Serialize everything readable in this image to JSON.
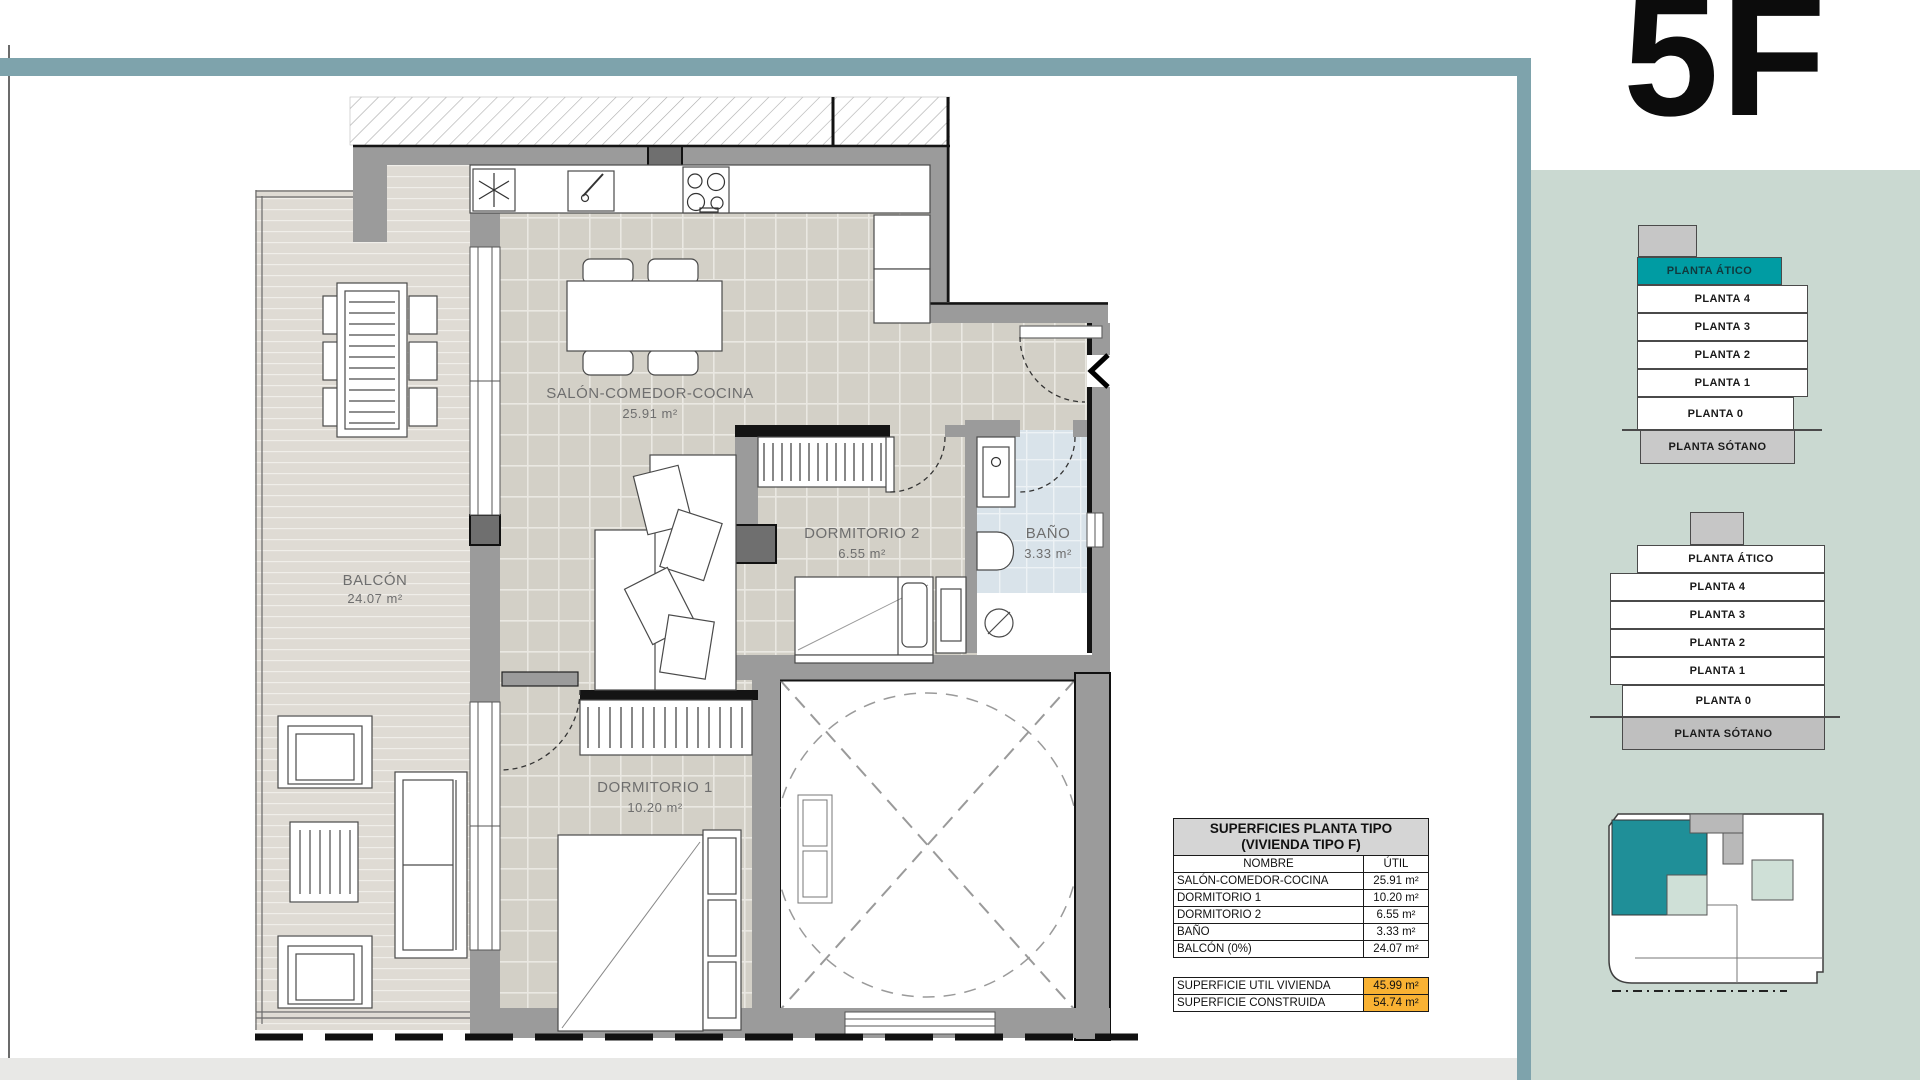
{
  "page": {
    "unit_label": "5F"
  },
  "floor_plan": {
    "rooms": {
      "salon": {
        "name": "SALÓN-COMEDOR-COCINA",
        "area": "25.91 m²"
      },
      "dormitorio2": {
        "name": "DORMITORIO 2",
        "area": "6.55 m²"
      },
      "bano": {
        "name": "BAÑO",
        "area": "3.33 m²"
      },
      "dormitorio1": {
        "name": "DORMITORIO 1",
        "area": "10.20 m²"
      },
      "balcon": {
        "name": "BALCÓN",
        "area": "24.07 m²"
      }
    }
  },
  "surfaces_table": {
    "title_line1": "SUPERFICIES PLANTA TIPO",
    "title_line2": "(VIVIENDA TIPO F)",
    "col_name": "NOMBRE",
    "col_util": "ÚTIL",
    "rows": [
      {
        "name": "SALÓN-COMEDOR-COCINA",
        "util": "25.91 m²"
      },
      {
        "name": "DORMITORIO 1",
        "util": "10.20 m²"
      },
      {
        "name": "DORMITORIO 2",
        "util": "6.55 m²"
      },
      {
        "name": "BAÑO",
        "util": "3.33 m²"
      },
      {
        "name": "BALCÓN (0%)",
        "util": "24.07 m²"
      }
    ],
    "totals": [
      {
        "name": "SUPERFICIE UTIL VIVIENDA",
        "util": "45.99 m²"
      },
      {
        "name": "SUPERFICIE CONSTRUIDA",
        "util": "54.74 m²"
      }
    ]
  },
  "sidebar": {
    "elevation_top": {
      "highlighted_floor": "PLANTA ÁTICO",
      "floors": [
        "PLANTA ÁTICO",
        "PLANTA 4",
        "PLANTA 3",
        "PLANTA 2",
        "PLANTA 1",
        "PLANTA 0",
        "PLANTA SÓTANO"
      ]
    },
    "elevation_bottom": {
      "floors": [
        "PLANTA ÁTICO",
        "PLANTA 4",
        "PLANTA 3",
        "PLANTA 2",
        "PLANTA 1",
        "PLANTA 0",
        "PLANTA SÓTANO"
      ]
    }
  },
  "colors": {
    "top_bar_teal": "#7EA3AC",
    "sidebar_panel_green": "#CAD9D1",
    "floor_highlight_teal": "#009CA3",
    "site_plan_unit_teal": "#1F8F98",
    "table_total_orange": "#F9B233",
    "bathroom_tile_blue": "#D9E3EA"
  }
}
